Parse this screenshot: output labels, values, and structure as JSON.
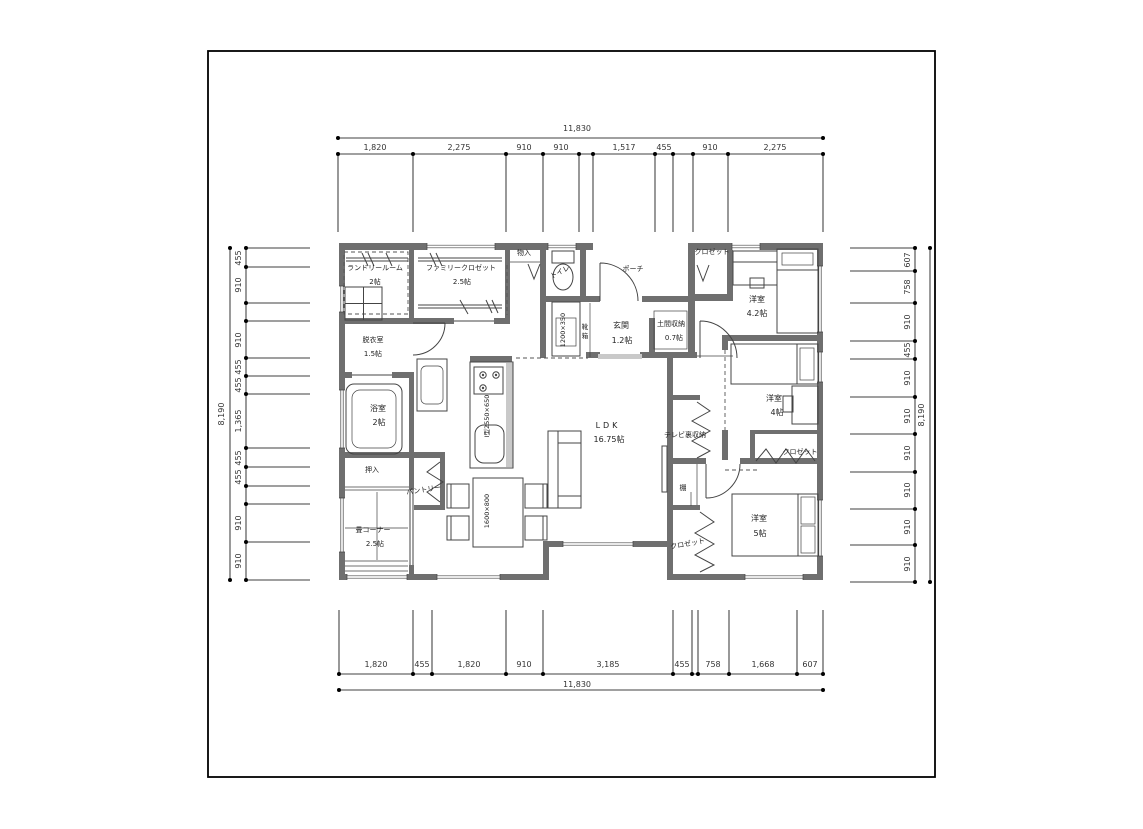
{
  "dims": {
    "top": {
      "total": "11,830",
      "segments": [
        "1,820",
        "2,275",
        "910",
        "910",
        "1,517",
        "455",
        "910",
        "2,275"
      ]
    },
    "bottom": {
      "total": "11,830",
      "segments": [
        "1,820",
        "455",
        "1,820",
        "910",
        "3,185",
        "455",
        "758",
        "1,668",
        "607"
      ]
    },
    "left": {
      "total": "8,190",
      "segments": [
        "455",
        "910",
        "910",
        "455",
        "455",
        "1,365",
        "455",
        "455",
        "910",
        "910"
      ]
    },
    "right": {
      "total": "8,190",
      "segments": [
        "607",
        "758",
        "910",
        "455",
        "910",
        "910",
        "910",
        "910",
        "910",
        "910"
      ]
    }
  },
  "rooms": {
    "laundry": {
      "name": "ランドリールーム",
      "size": "2帖"
    },
    "family_closet": {
      "name": "ファミリークロゼット",
      "size": "2.5帖"
    },
    "dressing": {
      "name": "脱衣室",
      "size": "1.5帖"
    },
    "bath": {
      "name": "浴室",
      "size": "2帖"
    },
    "oshiire": {
      "name": "押入"
    },
    "tatami": {
      "name": "畳コーナー",
      "size": "2.5帖"
    },
    "ldk": {
      "name": "LDK",
      "size": "16.75帖"
    },
    "genkan": {
      "name": "玄関",
      "size": "1.2帖"
    },
    "doma": {
      "name": "土間収納",
      "size": "0.7帖"
    },
    "bed42": {
      "name": "洋室",
      "size": "4.2帖"
    },
    "bed4": {
      "name": "洋室",
      "size": "4帖"
    },
    "bed5": {
      "name": "洋室",
      "size": "5帖"
    }
  },
  "labels": {
    "porch": "ポーチ",
    "toilet": "トイレ",
    "monoire": "物入",
    "closet": "クロゼット",
    "shoe_box": "靴箱",
    "shoe_box_top": "靴",
    "shoe_box_bottom": "箱",
    "tv_storage": "テレビ裏収納",
    "shelf": "棚",
    "pantry": "パントリー",
    "kitchen_size": "I型2550×650",
    "table_size": "1600×800",
    "shoebox_size": "1200×350"
  }
}
